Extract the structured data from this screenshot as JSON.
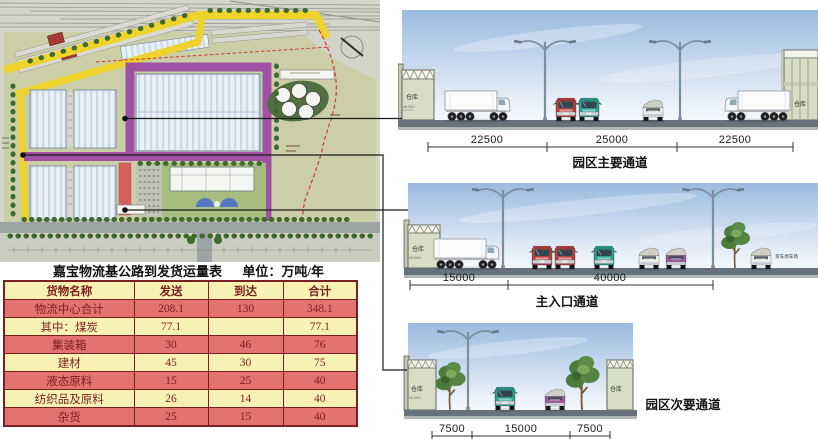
{
  "table": {
    "title": "嘉宝物流基公路到发货运量表",
    "unit": "单位：万吨/年",
    "headers": [
      "货物名称",
      "发送",
      "到达",
      "合计"
    ],
    "rows": [
      [
        "物流中心合计",
        "208.1",
        "130",
        "348.1"
      ],
      [
        "其中：煤炭",
        "77.1",
        "",
        "77.1"
      ],
      [
        "集装箱",
        "30",
        "46",
        "76"
      ],
      [
        "建材",
        "45",
        "30",
        "75"
      ],
      [
        "液态原料",
        "15",
        "25",
        "40"
      ],
      [
        "纺织品及原料",
        "26",
        "14",
        "40"
      ],
      [
        "杂货",
        "25",
        "15",
        "40"
      ]
    ]
  },
  "sections": [
    {
      "caption": "园区主要通道",
      "dimensions": [
        "22500",
        "25000",
        "22500"
      ],
      "warehouse_left": "仓库",
      "warehouse_right": "仓库",
      "level_label": "±0.000"
    },
    {
      "caption": "主入口通道",
      "dimensions": [
        "15000",
        "40000"
      ],
      "warehouse_left": "仓库",
      "level_label": "±0.000",
      "parking_label": "货车停车场"
    },
    {
      "caption": "园区次要通道",
      "dimensions": [
        "7500",
        "15000",
        "7500"
      ],
      "warehouse_left": "仓库",
      "warehouse_right": "仓库",
      "level_label": "±0.000"
    }
  ],
  "colors": {
    "road_yellow": "#EDD32B",
    "road_purple": "#A151A3",
    "road_red": "#D75C5C",
    "boundary_red_dash": "#CC3A33",
    "table_pink": "#E4726E",
    "table_yellow": "#F7F2B4",
    "table_ink": "#7B1F1F",
    "sky_top": "#9ABAE0",
    "ground": "#67727C",
    "truck_red": "#B4423E",
    "truck_teal": "#2F9E92",
    "truck_purple": "#9A5B9E"
  }
}
